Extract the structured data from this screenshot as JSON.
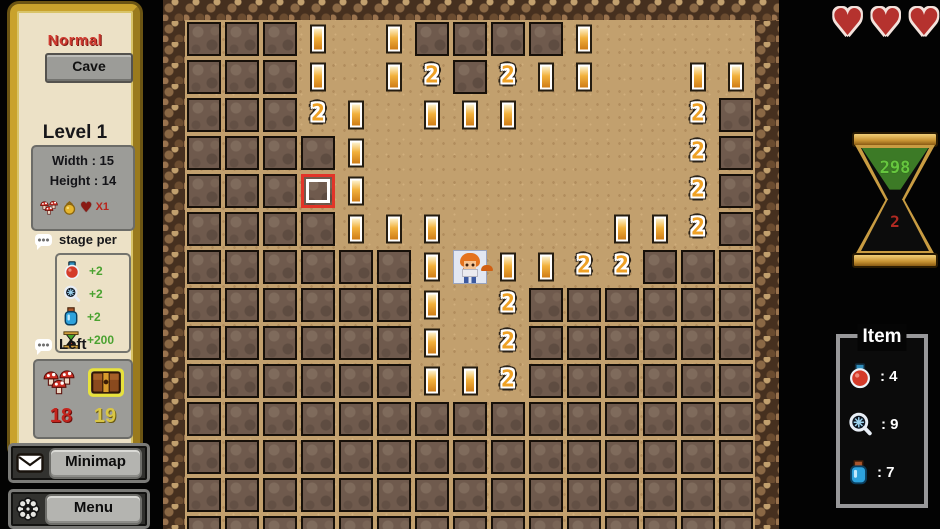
{
  "left_panel": {
    "difficulty": "Normal",
    "map_button": "Cave",
    "level": "Level 1",
    "width_label": "Width : 15",
    "height_label": "Height : 14",
    "heart_multiplier": "X1",
    "stage_per": {
      "label": "stage per",
      "rows": [
        {
          "icon": "red-potion",
          "value": "+2"
        },
        {
          "icon": "magnifier",
          "value": "+2"
        },
        {
          "icon": "blue-potion",
          "value": "+2"
        },
        {
          "icon": "hourglass",
          "value": "+200"
        }
      ]
    },
    "left_section": {
      "label": "Left",
      "mushrooms_left": "18",
      "chests_left": "19"
    },
    "minimap_button": "Minimap",
    "menu_button": "Menu"
  },
  "hud_right": {
    "hearts_count": 3,
    "heart_glyph": "♥",
    "timer": {
      "top": "298",
      "bottom": "2"
    },
    "item_panel": {
      "title": "Item",
      "items": [
        {
          "icon": "red-potion",
          "count": ": 4"
        },
        {
          "icon": "magnifier",
          "count": ": 9"
        },
        {
          "icon": "blue-potion",
          "count": ": 7"
        }
      ]
    }
  },
  "board": {
    "cols": 15,
    "rows": 14,
    "tile": 38,
    "legend": {
      "#": "covered",
      ".": "revealed",
      "1": "one",
      "2": "two",
      "P": "player",
      "C": "cursor"
    },
    "map": [
      "###1.1####1....",
      "###1.12#211..11",
      "###21.111....2#",
      "####1........2#",
      "###C1........2#",
      "####111....112#",
      "######1P1122###",
      "######1.2######",
      "######1.2######",
      "######112######",
      "###############",
      "###############",
      "###############",
      "###############"
    ]
  },
  "colors": {
    "sand": "#c2a06e",
    "covered_tile": "#6f5a4d",
    "panel_gold": "#c9a22c",
    "number_gold": "#efa125",
    "timer_green": "#66c63e",
    "timer_red": "#b02a22",
    "cursor_red": "#e23428",
    "heart_red": "#b5322e"
  }
}
